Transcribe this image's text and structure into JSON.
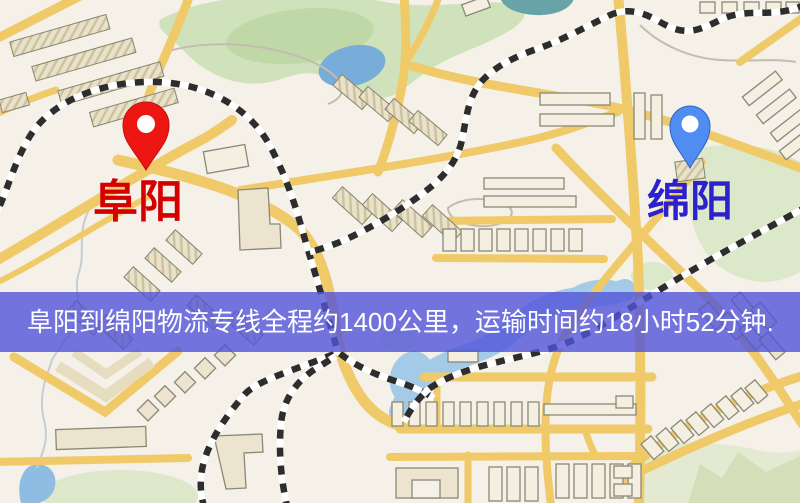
{
  "banner": {
    "text": "阜阳到绵阳物流专线全程约1400公里，运输时间约18小时52分钟.",
    "background_color": "#5154d8",
    "text_color": "#ffffff"
  },
  "markers": {
    "origin": {
      "label": "阜阳",
      "label_color": "#d40000",
      "pin_color": "#ee1613"
    },
    "destination": {
      "label": "绵阳",
      "label_color": "#2b22cc",
      "pin_color": "#4f8df2"
    }
  }
}
